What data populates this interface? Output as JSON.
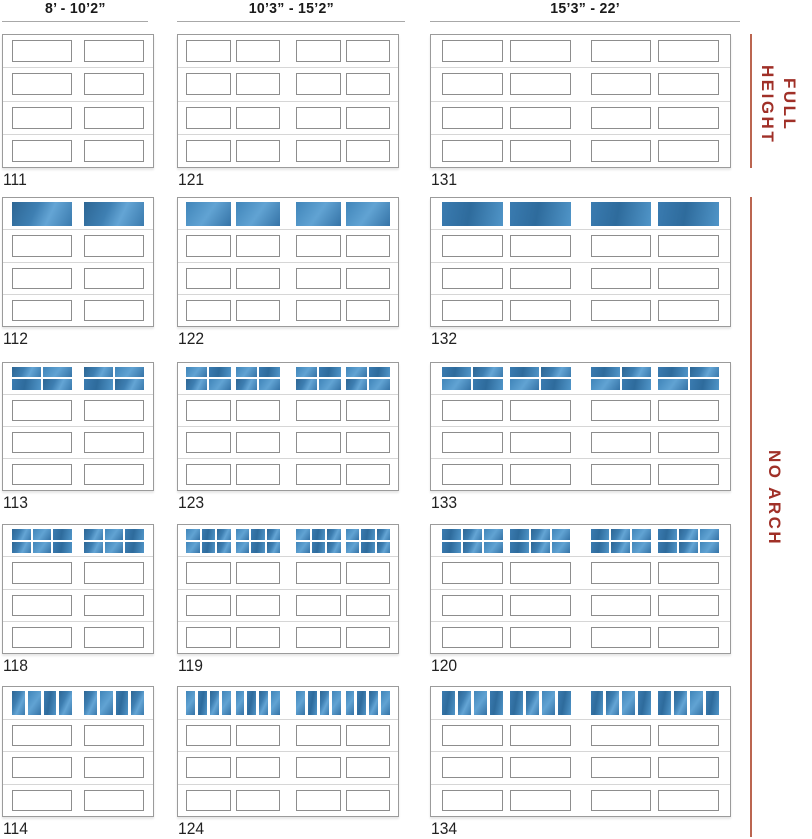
{
  "page": {
    "background": "#ffffff"
  },
  "headers": [
    "8’ - 10’2”",
    "10’3” - 15’2”",
    "15’3” - 22’"
  ],
  "rail": {
    "full_height": "FULL\nHEIGHT",
    "no_arch": "NO ARCH",
    "text_color": "#a03028",
    "line_color": "#bb6550"
  },
  "window_colors": {
    "dark": "#2d6694",
    "mid": "#3e7fb2",
    "light": "#64a5d5"
  },
  "door_sections_per_door": 4,
  "doors": [
    {
      "label": "111",
      "window": "none",
      "panel_columns": 2
    },
    {
      "label": "121",
      "window": "none",
      "panel_columns": 4
    },
    {
      "label": "131",
      "window": "none",
      "panel_columns": 4
    },
    {
      "label": "112",
      "window": "solid",
      "panel_columns": 2
    },
    {
      "label": "122",
      "window": "solid",
      "panel_columns": 4
    },
    {
      "label": "132",
      "window": "solid",
      "panel_columns": 4
    },
    {
      "label": "113",
      "window": "2x2",
      "panel_columns": 2
    },
    {
      "label": "123",
      "window": "2x2",
      "panel_columns": 4
    },
    {
      "label": "133",
      "window": "2x2",
      "panel_columns": 4
    },
    {
      "label": "118",
      "window": "2x3",
      "panel_columns": 2
    },
    {
      "label": "119",
      "window": "2x3",
      "panel_columns": 4
    },
    {
      "label": "120",
      "window": "2x3",
      "panel_columns": 4
    },
    {
      "label": "114",
      "window": "vertical-4",
      "panel_columns": 2
    },
    {
      "label": "124",
      "window": "vertical-4",
      "panel_columns": 4
    },
    {
      "label": "134",
      "window": "vertical-4",
      "panel_columns": 4
    }
  ]
}
